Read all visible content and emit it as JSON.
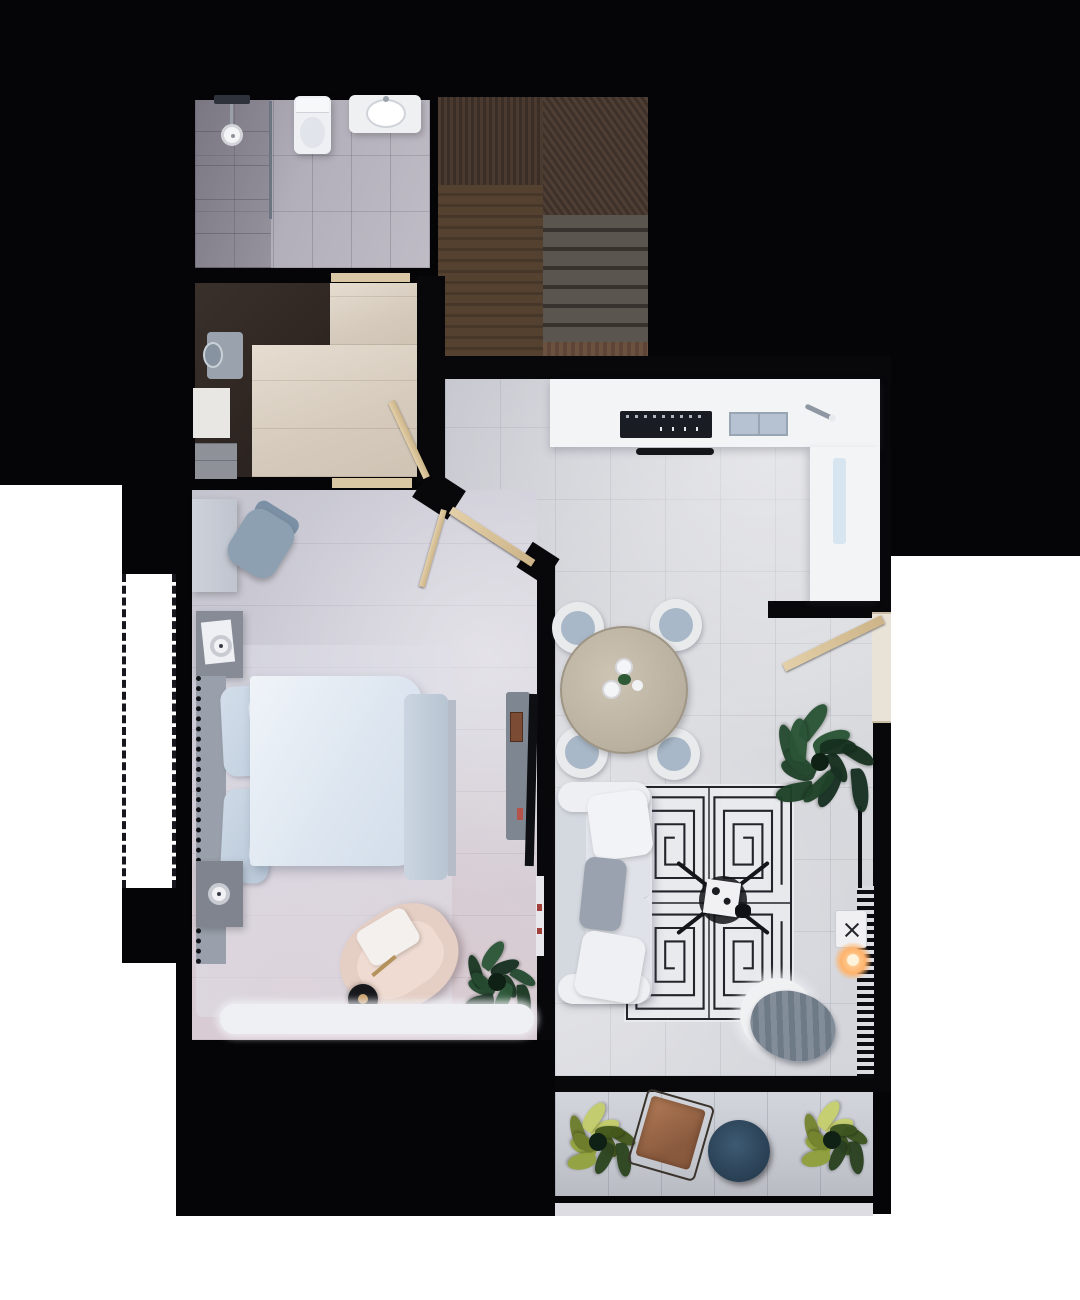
{
  "scene": {
    "kind": "3d-rendered-floor-plan",
    "view": "top-down",
    "text_visible": "none"
  },
  "palette": {
    "background": "#050507",
    "exterior_light": "#ffffff",
    "wall": "#08080b",
    "door_wood": "#d9c49c",
    "bathroom_floor": "#b2afba",
    "hall_floor": "#dcd2c5",
    "closet_dark": "#332a25",
    "stairs_dark_wood": "#44362c",
    "stairs_mid_wood": "#54402f",
    "stairs_tread": "#5b554f",
    "living_floor": "#d3d4da",
    "bedroom_floor": "#cecdd7",
    "balcony_floor": "#c8cad2",
    "kitchen_counter": "#f3f4f6",
    "cooktop": "#191d23",
    "sink": "#b6c2d1",
    "bed_duvet": "#e8eef6",
    "bed_pillow": "#c9d6e4",
    "armchair_blush": "#e5cec4",
    "sofa": "#e2e5ea",
    "rug_base": "#e9eaee",
    "rug_line": "#23242b",
    "pouf_blanket": "#7d8894",
    "balcony_table": "#2e4659",
    "lounge_leather": "#9a6a4c",
    "plant_dark_green": "#1e402a",
    "plant_yellow_green": "#b4c05e",
    "lamp_glow": "#ffb36b"
  },
  "legend": [
    "bathroom",
    "shower",
    "toilet",
    "sink-basin",
    "staircase",
    "closet",
    "washing-machine",
    "hallway",
    "kitchen-counter",
    "cooktop",
    "kitchen-sink",
    "entry-door",
    "bedroom",
    "double-bed",
    "nightstand",
    "table-lamp",
    "desk",
    "desk-chair",
    "tv-console",
    "armchair",
    "floor-lamp",
    "dining-table",
    "dining-chair",
    "sofa",
    "coffee-table",
    "greek-key-rug",
    "pouf",
    "radiator",
    "side-table",
    "potted-plant",
    "balcony",
    "lounge-chair",
    "balcony-table"
  ],
  "plants": [
    {
      "key": "living",
      "cx": 68,
      "cy": 68,
      "count": 13,
      "spread": 56,
      "lw": 46,
      "lh": 19,
      "colors": [
        "#16301f",
        "#1f4228",
        "#2a5435",
        "#173022",
        "#254b31"
      ]
    },
    {
      "key": "bedroom",
      "cx": 45,
      "cy": 52,
      "count": 10,
      "spread": 38,
      "lw": 36,
      "lh": 15,
      "colors": [
        "#1b3824",
        "#254a30",
        "#173021",
        "#2c5637"
      ]
    },
    {
      "key": "balcony-left",
      "cx": 40,
      "cy": 46,
      "count": 11,
      "spread": 36,
      "lw": 36,
      "lh": 16,
      "colors": [
        "#44581c",
        "#93a33f",
        "#c3cc6a",
        "#2c441f",
        "#6d7d2c"
      ]
    },
    {
      "key": "balcony-right",
      "cx": 40,
      "cy": 46,
      "count": 11,
      "spread": 35,
      "lw": 35,
      "lh": 16,
      "colors": [
        "#3c5420",
        "#8fa03c",
        "#c6cf6e",
        "#294020",
        "#75852f"
      ]
    }
  ]
}
